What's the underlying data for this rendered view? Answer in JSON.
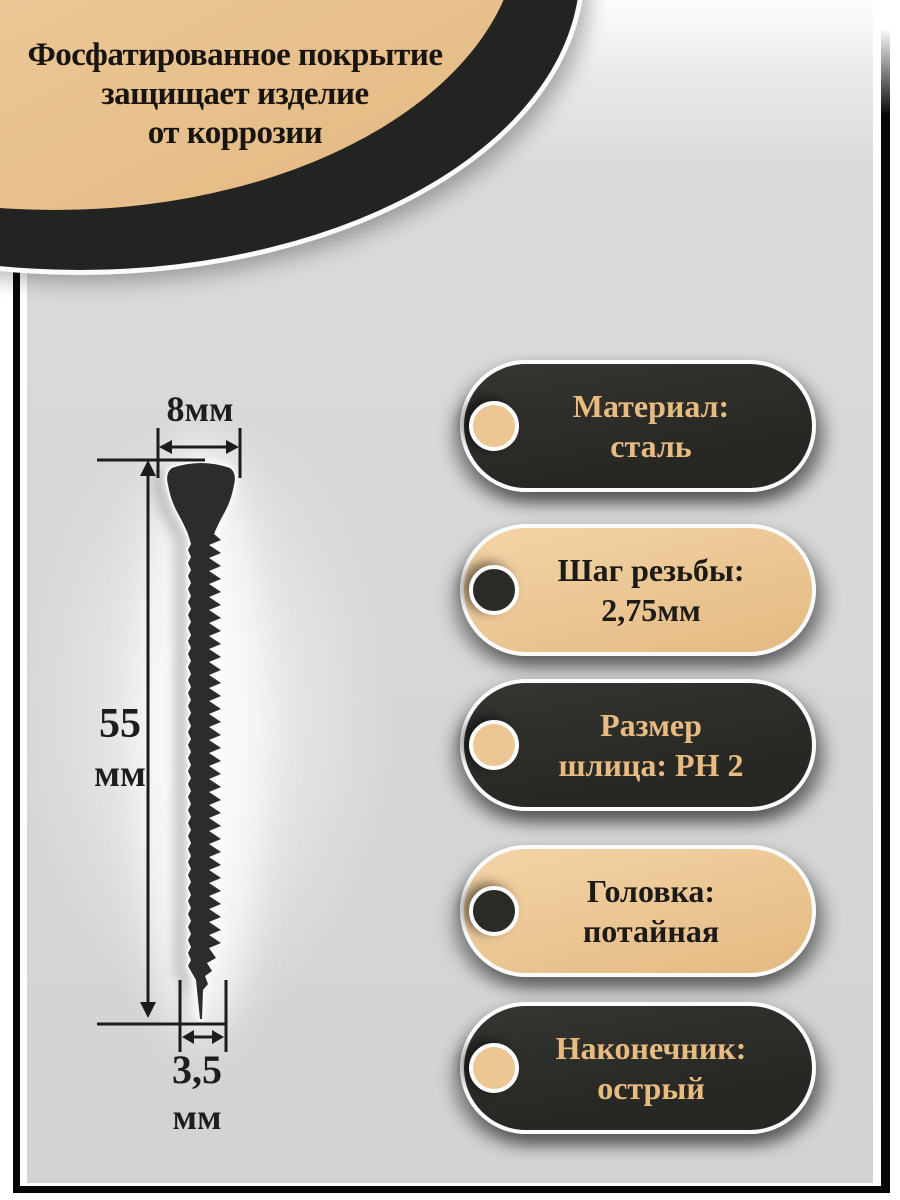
{
  "corner_badge": {
    "lines": [
      "Фосфатированное покрытие",
      "защищает изделие",
      "от коррозии"
    ]
  },
  "screw_dimensions": {
    "head_width": "8мм",
    "length_value": "55",
    "length_unit": "мм",
    "diameter_value": "3,5",
    "diameter_unit": "мм"
  },
  "spec_pills": [
    {
      "id": "material",
      "theme": "dark",
      "line1": "Материал:",
      "line2": "сталь"
    },
    {
      "id": "thread-pitch",
      "theme": "tan",
      "line1": "Шаг резьбы:",
      "line2": "2,75мм"
    },
    {
      "id": "drive-size",
      "theme": "dark",
      "line1": "Размер",
      "line2": "шлица: PH 2"
    },
    {
      "id": "head-type",
      "theme": "tan",
      "line1": "Головка:",
      "line2": "потайная"
    },
    {
      "id": "tip-type",
      "theme": "dark",
      "line1": "Наконечник:",
      "line2": "острый"
    }
  ],
  "colors": {
    "tan": "#ecc794",
    "tan_light": "#f0cf9f",
    "dark": "#2b2b29",
    "tan_text_on_dark": "#e8bc80",
    "background_gray": "#d6d8d7",
    "frame_black": "#070707",
    "white_ring": "#fcfcfc"
  }
}
